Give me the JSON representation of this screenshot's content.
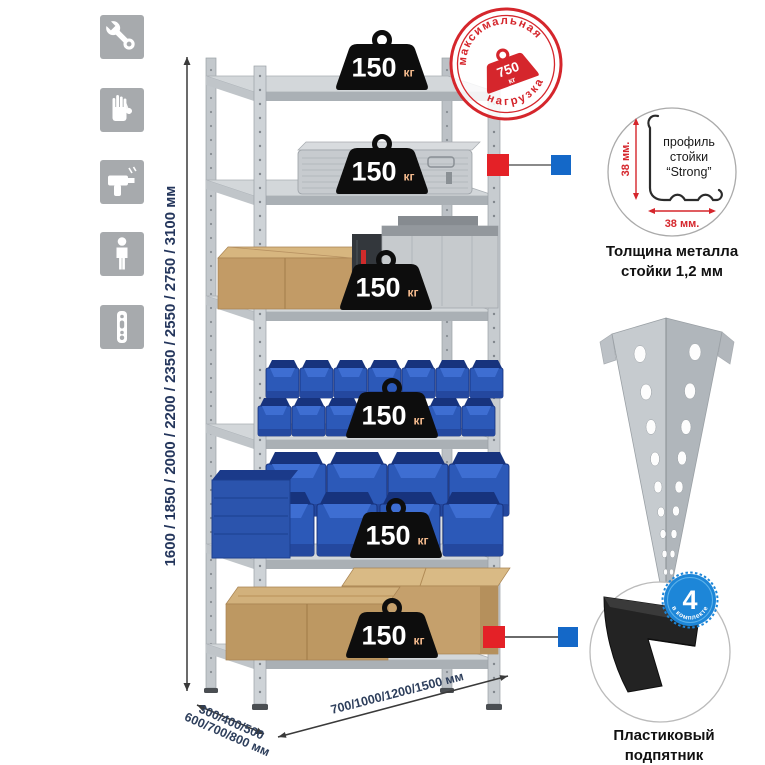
{
  "sidebar_icons": [
    {
      "name": "wrench"
    },
    {
      "name": "gloves"
    },
    {
      "name": "drill"
    },
    {
      "name": "person"
    },
    {
      "name": "perforated-post"
    }
  ],
  "dimensions": {
    "height_label": "1600 / 1850 / 2000 / 2200 / 2350 / 2550 / 2750 / 3100 мм",
    "depth_label_line1": "300/400/500",
    "depth_label_line2": "600/700/800 мм",
    "width_label": "700/1000/1200/1500 мм"
  },
  "max_load_stamp": {
    "arc_top": "максимальная",
    "arc_bottom": "нагрузка",
    "value": "750",
    "unit": "кг"
  },
  "shelf_badges": [
    {
      "value": "150",
      "unit": "кг"
    },
    {
      "value": "150",
      "unit": "кг"
    },
    {
      "value": "150",
      "unit": "кг"
    },
    {
      "value": "150",
      "unit": "кг"
    },
    {
      "value": "150",
      "unit": "кг"
    },
    {
      "value": "150",
      "unit": "кг"
    }
  ],
  "profile_callout": {
    "line1": "профиль",
    "line2": "стойки",
    "line3": "“Strong”",
    "vertical_dim": "38 мм.",
    "horizontal_dim": "38 мм.",
    "caption_line1": "Толщина металла",
    "caption_line2": "стойки 1,2 мм"
  },
  "foot_callout": {
    "badge_count": "4",
    "badge_arc": "в комплекте",
    "caption_line1": "Пластиковый",
    "caption_line2": "подпятник"
  },
  "colors": {
    "stamp_red": "#d5262c",
    "connector_red": "#e42127",
    "connector_blue": "#1468c8",
    "badge_blue": "#1d86d8",
    "dim_text": "#24365c",
    "bin_blue": "#2c59b8"
  }
}
